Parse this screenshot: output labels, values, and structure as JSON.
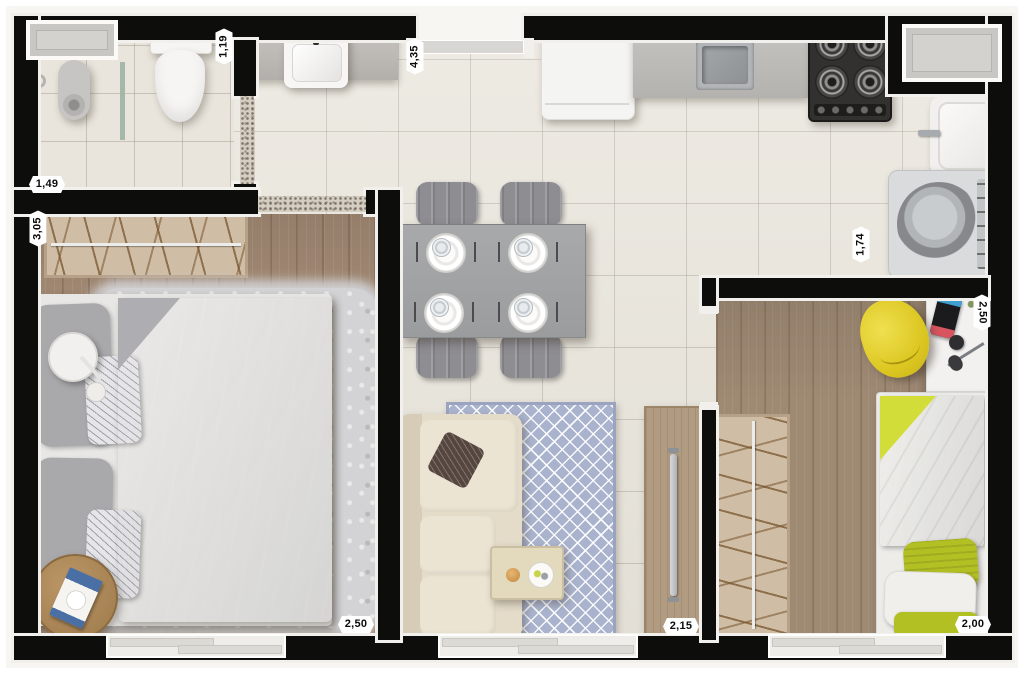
{
  "colors": {
    "wall": "#0d0d0c",
    "tile_floor": "#eae6dd",
    "wood_floor_main_bedroom": "#a58c76",
    "wood_floor_second_bedroom": "#9e8973",
    "living_rug_blue": "#aab3cd",
    "second_bed_green": "#b8c41f",
    "desk_chair_yellow": "#e3ce29",
    "main_bed_gray": "#8e8d91",
    "sofa_cream": "#e4dbc9"
  },
  "dimensions": {
    "bathroom_width": "1,49",
    "bathroom_depth": "1,19",
    "hall_kitchen_length": "4,35",
    "bedroom1_depth": "3,05",
    "bedroom1_width": "2,50",
    "service_area_width": "1,74",
    "bedroom2_depth": "2,50",
    "living_width": "2,15",
    "bedroom2_width": "2,00"
  },
  "rooms": {
    "bathroom": {
      "furniture": [
        "shower",
        "floor-drain",
        "glass-partition",
        "toilet",
        "window"
      ]
    },
    "hall": {
      "furniture": [
        "vanity-counter",
        "washbasin",
        "entry-door"
      ]
    },
    "kitchen": {
      "furniture": [
        "refrigerator",
        "countertop",
        "kitchen-sink",
        "gas-cooktop",
        "window"
      ]
    },
    "service_area": {
      "furniture": [
        "laundry-tub",
        "washing-machine"
      ]
    },
    "bedroom1": {
      "furniture": [
        "wardrobe",
        "double-bed",
        "pillows",
        "fluffy-rug",
        "floor-lamp",
        "round-side-table",
        "magazine",
        "window"
      ]
    },
    "dining": {
      "furniture": [
        "dining-table",
        "four-chairs",
        "four-place-settings"
      ]
    },
    "living": {
      "furniture": [
        "sofa",
        "throw-pillow",
        "diamond-rug",
        "coffee-table",
        "tv-panel",
        "window"
      ]
    },
    "bedroom2": {
      "furniture": [
        "wardrobe",
        "single-bed",
        "green-bedding",
        "desk",
        "yellow-chair",
        "game-console",
        "plant",
        "window"
      ]
    }
  }
}
